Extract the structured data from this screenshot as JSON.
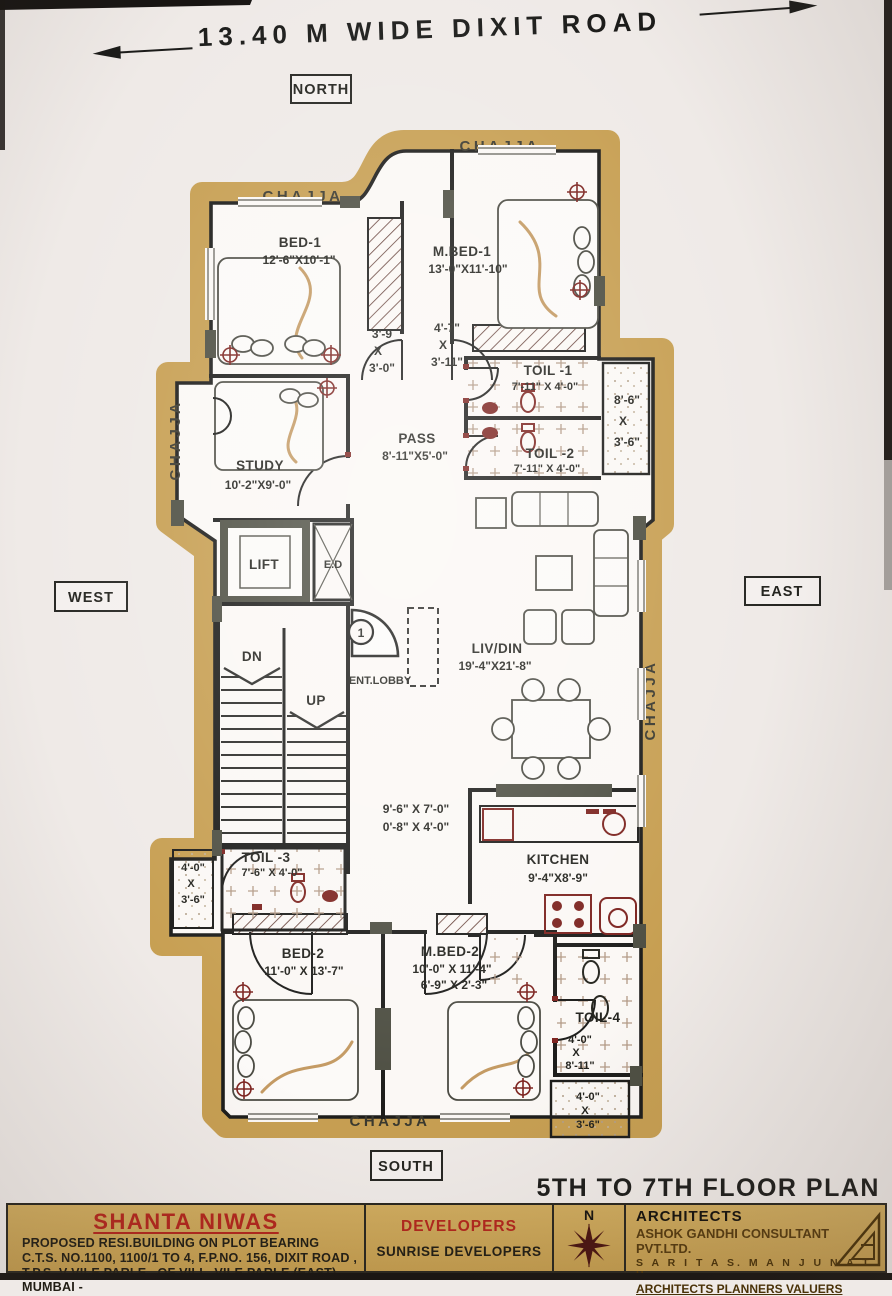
{
  "road": {
    "label": "13.40 M WIDE DIXIT ROAD"
  },
  "compass": {
    "north": "NORTH",
    "south": "SOUTH",
    "east": "EAST",
    "west": "WEST"
  },
  "plan_title": "5TH TO 7TH FLOOR PLAN",
  "chajja": {
    "top_left": "CHAJJA",
    "top_right": "CHAJJA",
    "west": "CHAJJA",
    "east": "CHAJJA",
    "bottom": "CHAJJA"
  },
  "rooms": {
    "bed1": {
      "name": "BED-1",
      "dims": "12'-6\"X10'-1\""
    },
    "mbed1": {
      "name": "M.BED-1",
      "dims": "13'-0\"X11'-10\""
    },
    "lobby1": {
      "l1": "3'-9",
      "l2": "X",
      "l3": "3'-0\""
    },
    "lobby2": {
      "l1": "4'-7\"",
      "l2": "X",
      "l3": "3'-11\""
    },
    "toil1": {
      "name": "TOIL -1",
      "dims": "7'-11\" X 4'-0\""
    },
    "toil2": {
      "name": "TOIL -2",
      "dims": "7'-11\" X 4'-0\""
    },
    "balcony_ne": {
      "l1": "8'-6\"",
      "l2": "X",
      "l3": "3'-6\""
    },
    "pass": {
      "name": "PASS",
      "dims": "8'-11\"X5'-0\""
    },
    "study": {
      "name": "STUDY",
      "dims": "10'-2\"X9'-0\""
    },
    "lift": {
      "name": "LIFT"
    },
    "ed": {
      "name": "E.D"
    },
    "stairs": {
      "dn": "DN",
      "up": "UP"
    },
    "ent_lobby": {
      "name": "ENT.LOBBY",
      "door_no": "1"
    },
    "livdin": {
      "name": "LIV/DIN",
      "dims": "19'-4\"X21'-8\""
    },
    "passage2": {
      "l1": "9'-6\" X 7'-0\"",
      "l2": "0'-8\" X 4'-0\""
    },
    "kitchen": {
      "name": "KITCHEN",
      "dims": "9'-4\"X8'-9\""
    },
    "balcony_w": {
      "l1": "4'-0\"",
      "l2": "X",
      "l3": "3'-6\""
    },
    "toil3": {
      "name": "TOIL -3",
      "dims": "7'-6\" X 4'-0\""
    },
    "bed2": {
      "name": "BED-2",
      "dims": "11'-0\" X 13'-7\""
    },
    "mbed2": {
      "name": "M.BED-2",
      "dims1": "10'-0\" X 11'-4\"",
      "dims2": "6'-9\" X 2'-3\""
    },
    "toil4": {
      "name": "TOIL-4",
      "l1": "4'-0\"",
      "l2": "X",
      "l3": "8'-11\""
    },
    "balcony_s": {
      "l1": "4'-0\"",
      "l2": "X",
      "l3": "3'-6\""
    }
  },
  "title_block": {
    "project": "SHANTA NIWAS",
    "line1": "PROPOSED RESI.BUILDING ON PLOT BEARING",
    "line2": "C.T.S. NO.1100, 1100/1 TO 4, F.P.NO. 156,  DIXIT ROAD ,",
    "line3": "T.P.S. V  VILE PARLE  , OF VILL .VILE PARLE (EAST) , MUMBAI -",
    "developers_label": "DEVELOPERS",
    "developers_name": "SUNRISE DEVELOPERS",
    "compass_n": "N",
    "architects_label": "ARCHITECTS",
    "architects_line1": "ASHOK GANDHI CONSULTANT PVT.LTD.",
    "architects_line2": "S A R I T A  S.  M A N J U N A T H",
    "architects_line3": "ARCHITECTS  PLANNERS  VALUERS"
  },
  "colors": {
    "chajja_gold": "#c79f52",
    "title_strip_gold": "#c9a458",
    "accent_red": "#b1261c",
    "fixture_maroon": "#7d2420",
    "wall_ink": "#1d1d1b",
    "column_olive": "#4e4f43",
    "paper": "#efeae7"
  }
}
